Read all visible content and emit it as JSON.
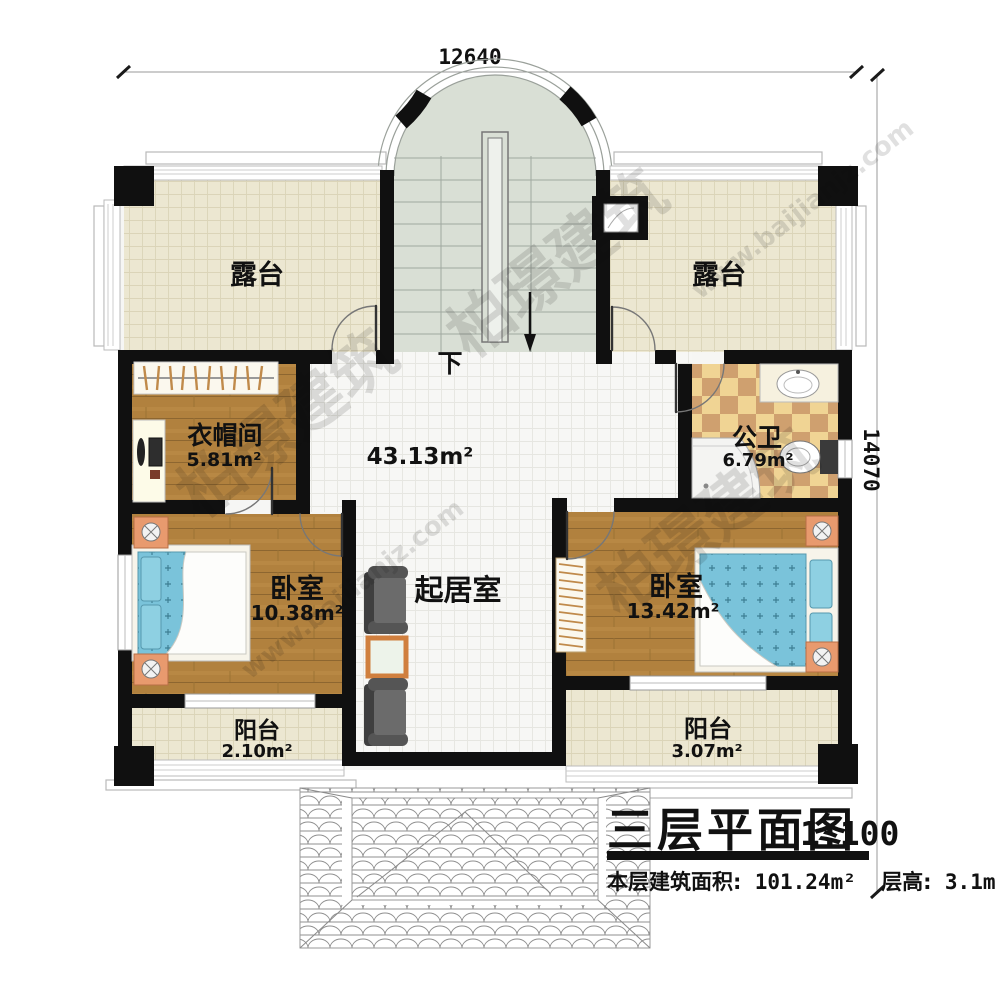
{
  "dimensions": {
    "top": "12640",
    "right": "14070"
  },
  "stairs": {
    "down_label": "下"
  },
  "rooms": {
    "terrace_left": {
      "name": "露台"
    },
    "terrace_right": {
      "name": "露台"
    },
    "cloakroom": {
      "name": "衣帽间",
      "area": "5.81m²"
    },
    "bathroom": {
      "name": "公卫",
      "area": "6.79m²"
    },
    "living": {
      "name": "起居室",
      "area": "43.13m²"
    },
    "bedroom_left": {
      "name": "卧室",
      "area": "10.38m²"
    },
    "bedroom_right": {
      "name": "卧室",
      "area": "13.42m²"
    },
    "balcony_left": {
      "name": "阳台",
      "area": "2.10m²"
    },
    "balcony_right": {
      "name": "阳台",
      "area": "3.07m²"
    }
  },
  "title_block": {
    "title": "三层平面图",
    "scale": "1:100",
    "floor_area_label": "本层建筑面积:",
    "floor_area_value": "101.24m²",
    "floor_height_label": "层高:",
    "floor_height_value": "3.1m"
  },
  "watermark": {
    "brand": "柏璟建筑",
    "site": "www.baijianjz.com"
  },
  "colors": {
    "wall": "#101010",
    "wood_floor": "#b1813e",
    "tile_cream": "#ece7d1",
    "stair_floor": "#d9dfd5",
    "checker_light": "#f0d494",
    "checker_dark": "#cfa06f",
    "bed_blue": "#7ac3da",
    "accent_orange": "#e89a6e"
  }
}
